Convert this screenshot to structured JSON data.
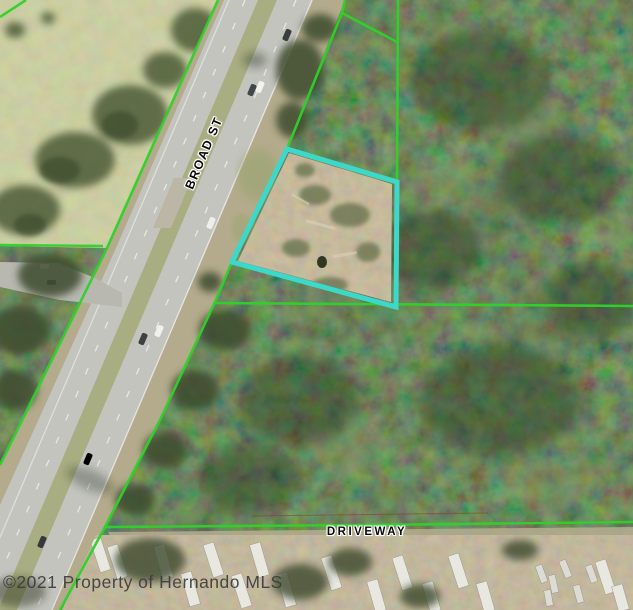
{
  "map": {
    "road_label": "BROAD ST",
    "driveway_label": "DRIVEWAY",
    "watermark": "©2021 Property of Hernando MLS",
    "colors": {
      "parcel_boundary_green": "#2fd12b",
      "highlight_cyan": "#3cd9cb",
      "watermark_gray": "#3c3c3c",
      "label_black": "#0a0a0a"
    },
    "highlight_parcel": {
      "points": "287,149 397,182 396,307 232,262"
    },
    "parcel_lines": {
      "corner_nw": "0,17 26,0",
      "road_left": "218,0 107,248 0,465",
      "west_horizontal": "0,245 103,246",
      "road_right": "345,0 342,13 287,149 232,262 215,302 160,420 105,527 60,610",
      "north_spur": "342,13 397,42",
      "north_vertical": "398,0 397,182",
      "mid_horizontal": "215,303 633,306",
      "driveway": "105,527 370,525 633,522"
    }
  }
}
